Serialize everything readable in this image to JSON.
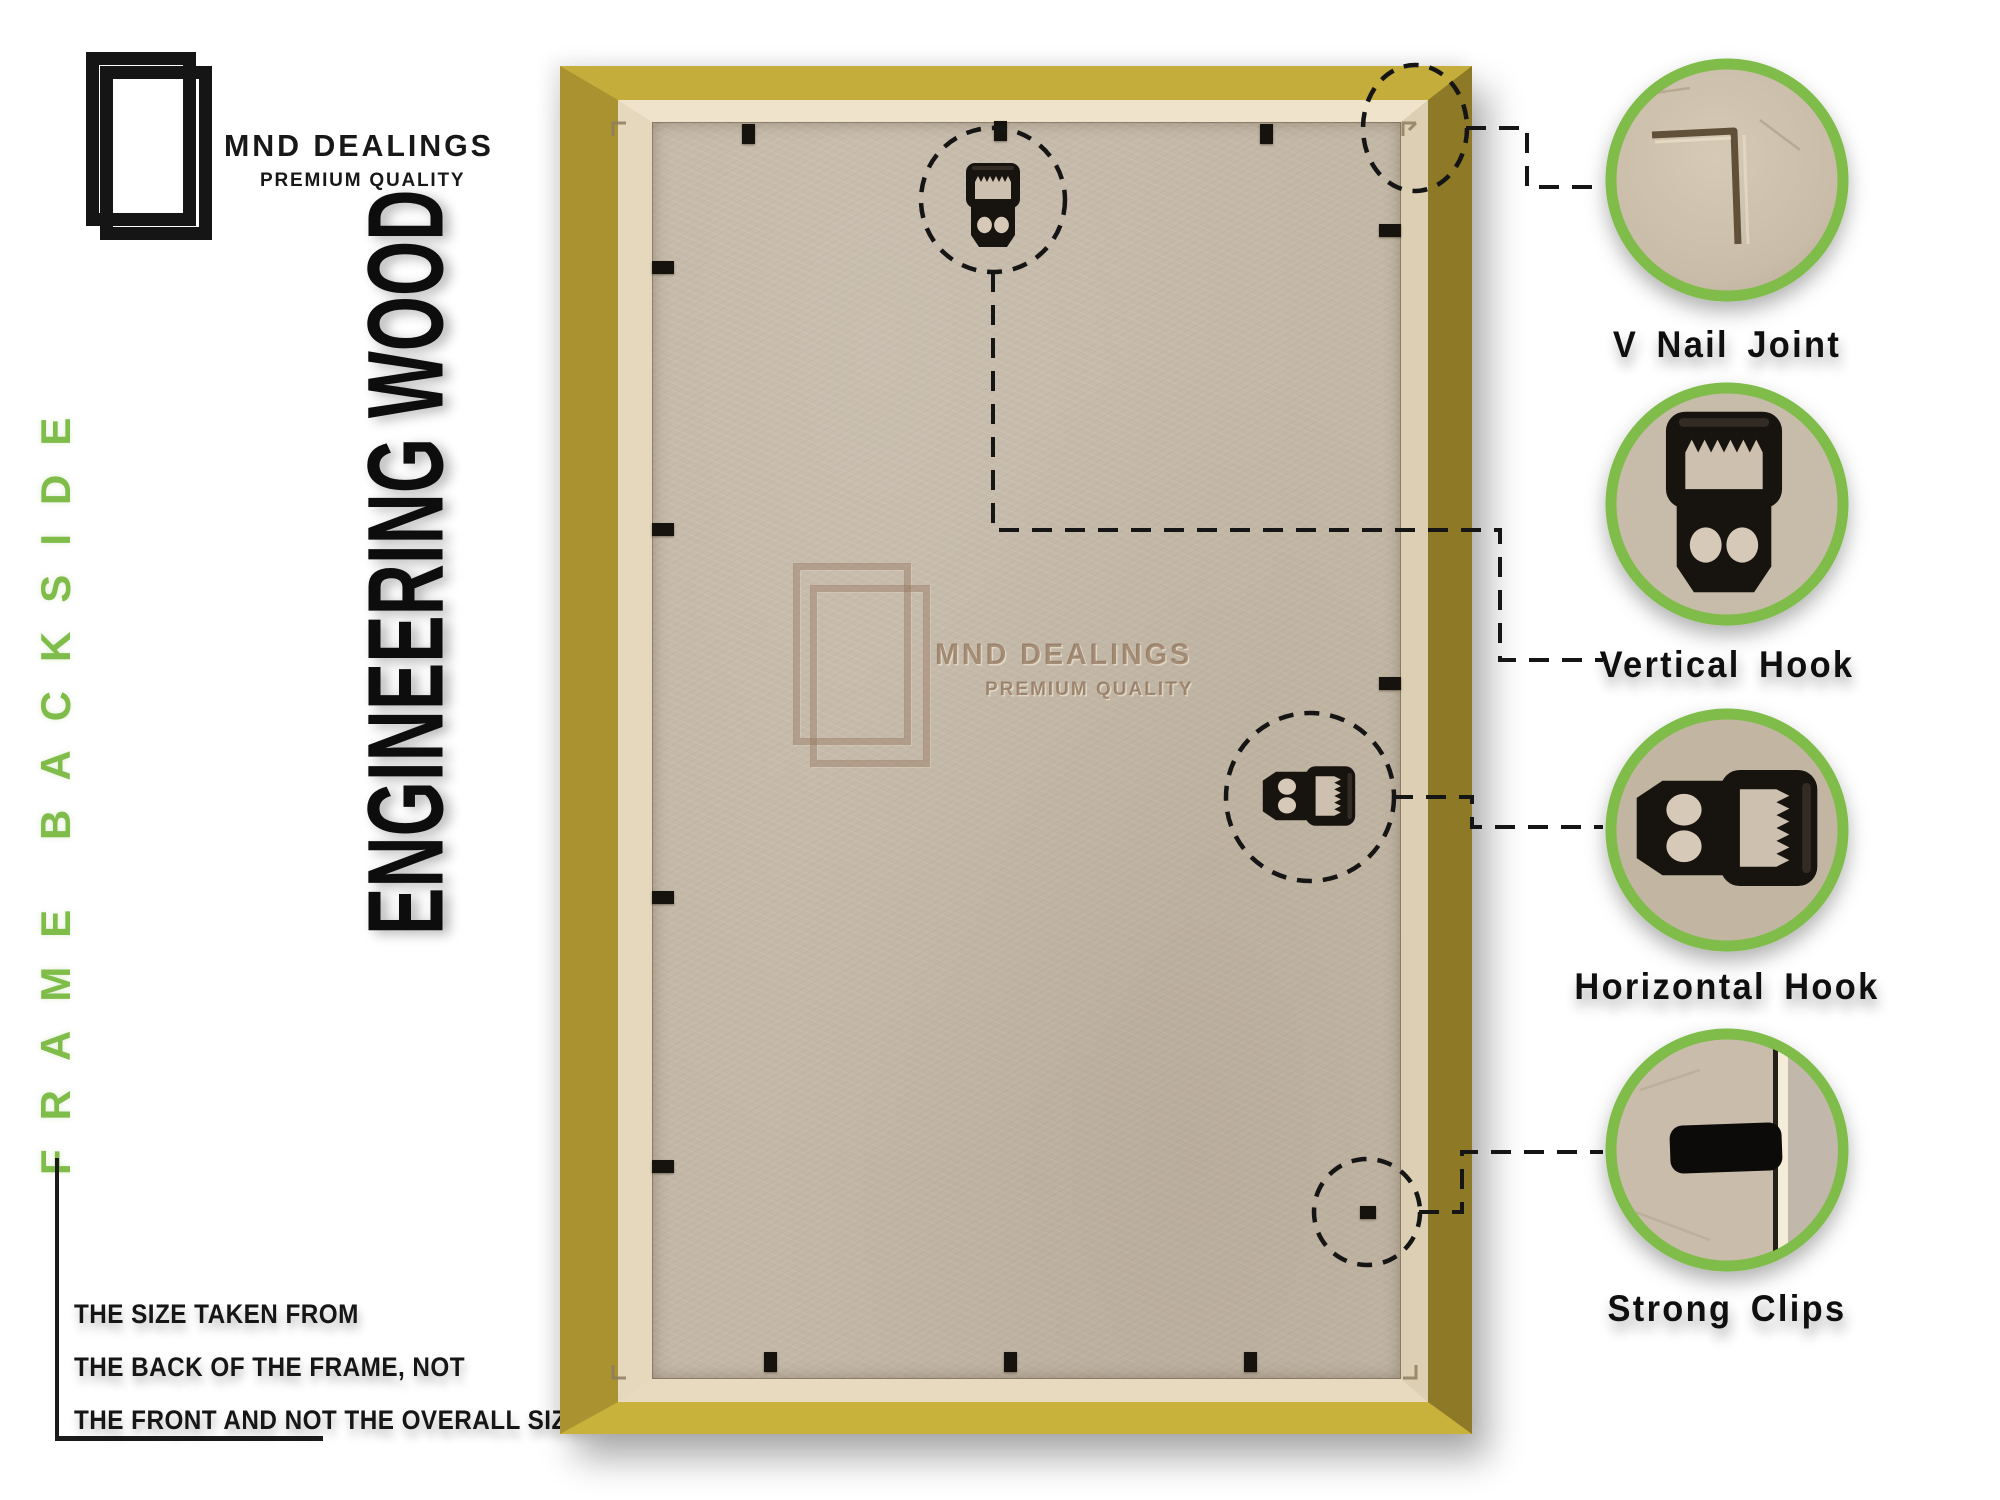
{
  "brand": {
    "name": "MND DEALINGS",
    "tagline": "PREMIUM QUALITY"
  },
  "side_label": "FRAME BACKSIDE",
  "headline": "ENGINEERING WOOD",
  "note": {
    "line1": "THE SIZE TAKEN FROM",
    "line2": "THE BACK OF THE FRAME, NOT",
    "line3": "THE FRONT AND NOT THE OVERALL SIZE."
  },
  "watermark": {
    "name": "MND DEALINGS",
    "tagline": "PREMIUM QUALITY"
  },
  "callouts": [
    {
      "id": "v-nail-joint",
      "label": "V Nail Joint"
    },
    {
      "id": "vertical-hook",
      "label": "Vertical Hook"
    },
    {
      "id": "horizontal-hook",
      "label": "Horizontal Hook"
    },
    {
      "id": "strong-clips",
      "label": "Strong Clips"
    }
  ],
  "colors": {
    "accent_green": "#7fbc4a",
    "frame_gold": "#c4ad3a",
    "frame_gold_dark": "#8d7926",
    "lip_cream": "#e8dabf",
    "board_tan": "#c3b7a6",
    "hardware_black": "#16120e"
  }
}
